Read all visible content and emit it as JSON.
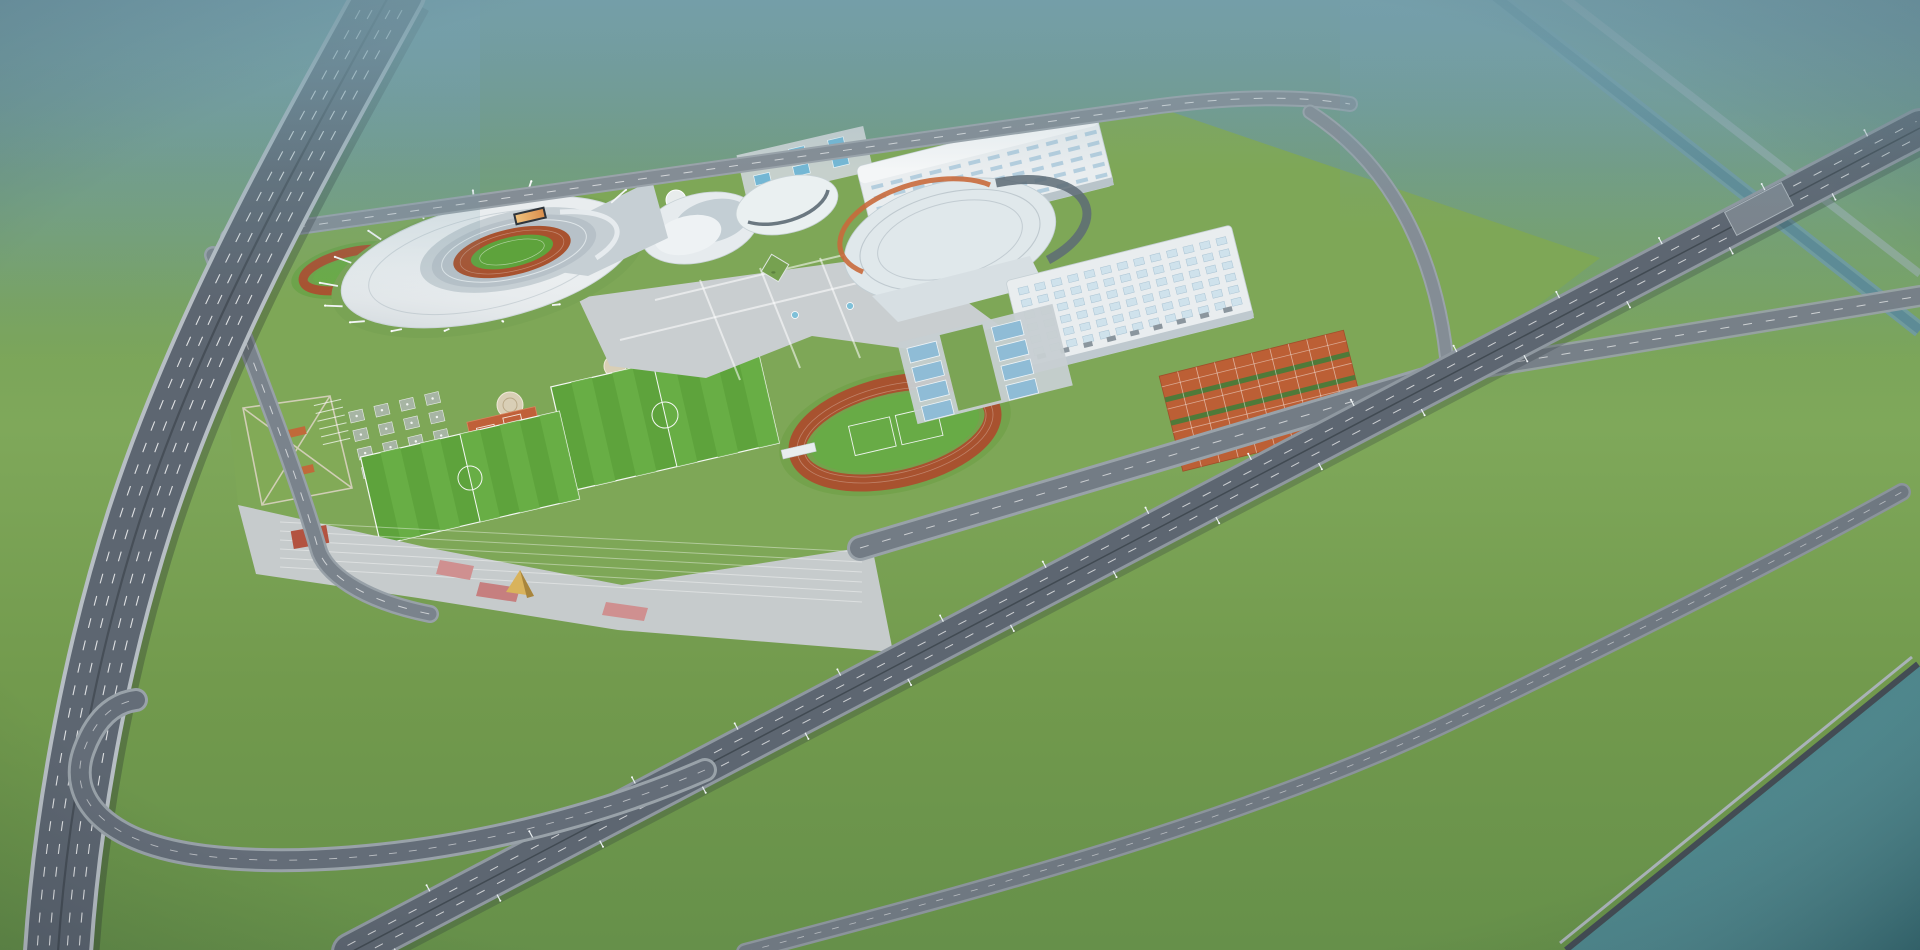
{
  "scene_type": "aerial architectural rendering",
  "subject": "sports-complex master plan with stadium, arena halls, training fields, interchange, park and river",
  "palette": {
    "haze": "#74a0b0",
    "grass_base": "#7ba557",
    "grass_campus": "#7ea757",
    "grass_park": "#6f9a47",
    "pitch": "#5ea33c",
    "pitch_stripe": "#6ab047",
    "track": "#a8522f",
    "tennis": "#bc5f35",
    "court_blue": "#8fbcd6",
    "pool": "#74b7d4",
    "roof_white": "#e9edef",
    "roof_shade": "#b9c4cb",
    "roof_accent_orange": "#c96a3c",
    "plaza": "#c9ced0",
    "road_dark": "#5d6671",
    "road_mid": "#6f7881",
    "road_light": "#9aa3aa",
    "marking": "#ffffff",
    "river": "#458086",
    "canal": "#6f9aa4",
    "tree_dark": "#3c6530",
    "tree_green": "#4a7a3a",
    "tree_light": "#5c8a43",
    "tree_autumn": "#c8832f",
    "city_ghost": "#cfe3e8",
    "gold": "#d4ab54"
  },
  "elements": [
    {
      "name": "city-skyline"
    },
    {
      "name": "elevated-highway"
    },
    {
      "name": "interchange-loop"
    },
    {
      "name": "main-boulevard"
    },
    {
      "name": "campus-front-road"
    },
    {
      "name": "park-avenue"
    },
    {
      "name": "canal"
    },
    {
      "name": "river"
    },
    {
      "name": "main-stadium"
    },
    {
      "name": "practice-track"
    },
    {
      "name": "gymnasium-shells"
    },
    {
      "name": "arena-hall"
    },
    {
      "name": "exhibition-hall"
    },
    {
      "name": "training-hall"
    },
    {
      "name": "central-plaza-fountains"
    },
    {
      "name": "outdoor-pools"
    },
    {
      "name": "blue-sports-courts"
    },
    {
      "name": "tennis-courts"
    },
    {
      "name": "clay-courts"
    },
    {
      "name": "soccer-fields"
    },
    {
      "name": "running-track-field"
    },
    {
      "name": "pavilion-grid"
    },
    {
      "name": "kite-lawn"
    },
    {
      "name": "south-terraces"
    },
    {
      "name": "gold-pavilion"
    },
    {
      "name": "urban-park"
    }
  ]
}
